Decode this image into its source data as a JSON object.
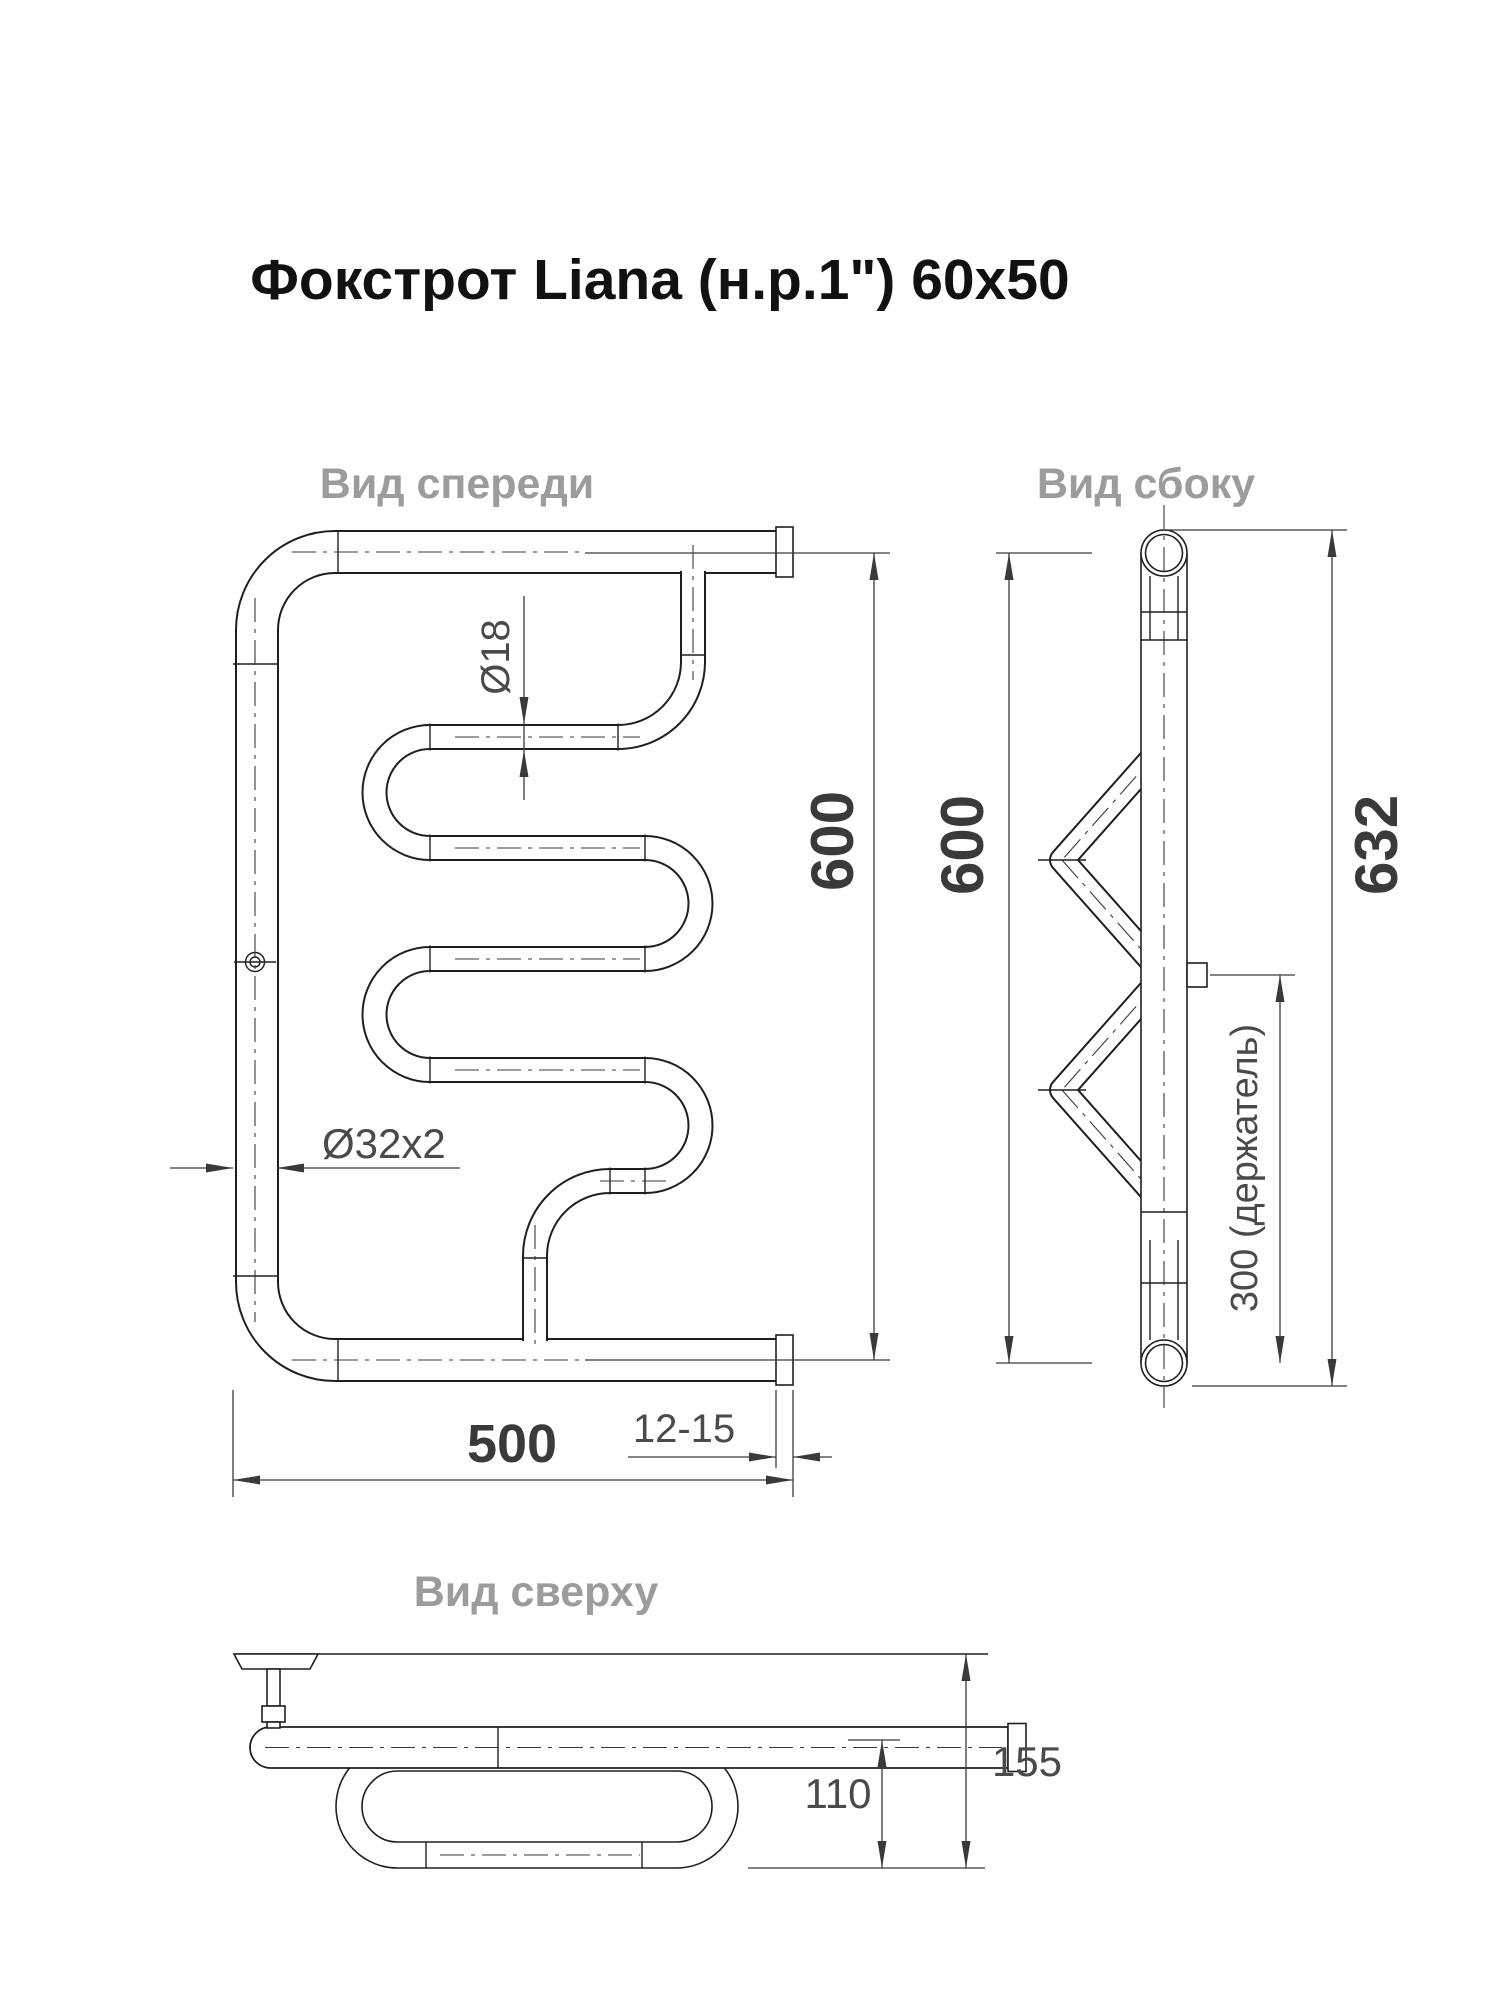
{
  "title": "Фокстрот Liana (н.р.1\") 60x50",
  "colors": {
    "line": "#1f1f1f",
    "dimension": "#3a3a3a",
    "dim_text": "#4a4a4a",
    "view_label": "#9c9c9c",
    "title_text": "#111111",
    "background": "#ffffff"
  },
  "views": {
    "front": {
      "label": "Вид спереди",
      "dims": {
        "coil_pipe_diameter": "Ø18",
        "main_pipe_diameter": "Ø32x2",
        "height": "600",
        "width": "500",
        "fitting_length": "12-15"
      }
    },
    "side": {
      "label": "Вид сбоку",
      "dims": {
        "height": "600",
        "overall_height": "632",
        "holder_offset": "300 (держатель)"
      }
    },
    "top": {
      "label": "Вид сверху",
      "dims": {
        "loop_depth": "110",
        "overall_depth": "155"
      }
    }
  }
}
